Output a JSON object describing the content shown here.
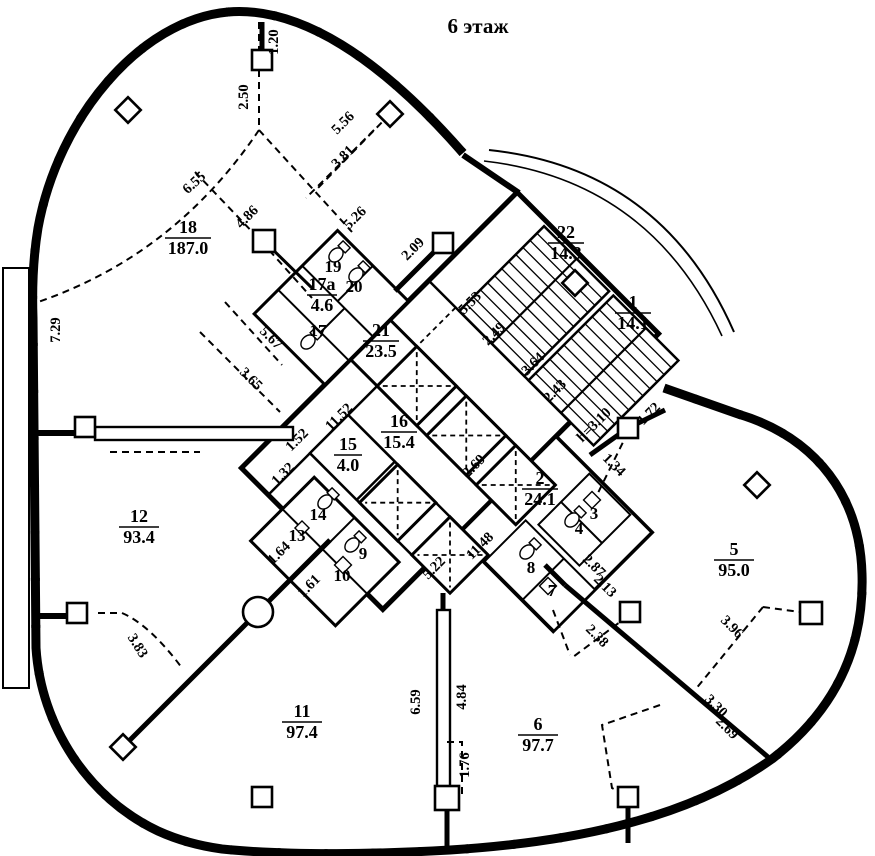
{
  "title": "6 этаж",
  "floor_plan": {
    "rooms": {
      "r18": {
        "number": "18",
        "area": "187.0"
      },
      "r17a": {
        "number": "17а",
        "area": "4.6"
      },
      "r17": {
        "number": "17"
      },
      "r19": {
        "number": "19"
      },
      "r20": {
        "number": "20"
      },
      "r21": {
        "number": "21",
        "area": "23.5"
      },
      "r22": {
        "number": "22",
        "area": "14.3"
      },
      "r1": {
        "number": "1",
        "area": "14.1"
      },
      "r16": {
        "number": "16",
        "area": "15.4"
      },
      "r15": {
        "number": "15",
        "area": "4.0"
      },
      "r2": {
        "number": "2",
        "area": "24.1"
      },
      "r3": {
        "number": "3"
      },
      "r4": {
        "number": "4"
      },
      "r7": {
        "number": "7"
      },
      "r8": {
        "number": "8"
      },
      "r9": {
        "number": "9"
      },
      "r10": {
        "number": "10"
      },
      "r13": {
        "number": "13"
      },
      "r14": {
        "number": "14"
      },
      "r12": {
        "number": "12",
        "area": "93.4"
      },
      "r11": {
        "number": "11",
        "area": "97.4"
      },
      "r6": {
        "number": "6",
        "area": "97.7"
      },
      "r5": {
        "number": "5",
        "area": "95.0"
      }
    },
    "dims": {
      "k120": "1.20",
      "k250": "2.50",
      "k655": "6.55",
      "k556": "5.56",
      "k381": "3.81",
      "k486": "4.86",
      "k526": "5.26",
      "k209": "2.09",
      "k729": "7.29",
      "k567": "5.67",
      "k365": "3.65",
      "k1152": "11.52",
      "k152": "1.52",
      "k132": "1.32",
      "k164": "1.64",
      "k161": "1.61",
      "k553": "5.53",
      "k249": "2.49",
      "k364": "3.64",
      "k243": "2.43",
      "k269a": "2.69",
      "k1148": "11.48",
      "k522": "5.22",
      "kh310": "h=3.10",
      "k172": "1.72",
      "k134": "1.34",
      "k287": "2.87",
      "k213": "2.13",
      "k238": "2.38",
      "k396": "3.96",
      "k330": "3.30",
      "k269b": "2.69",
      "k383": "3.83",
      "k659": "6.59",
      "k484": "4.84",
      "k176": "1.76"
    }
  }
}
